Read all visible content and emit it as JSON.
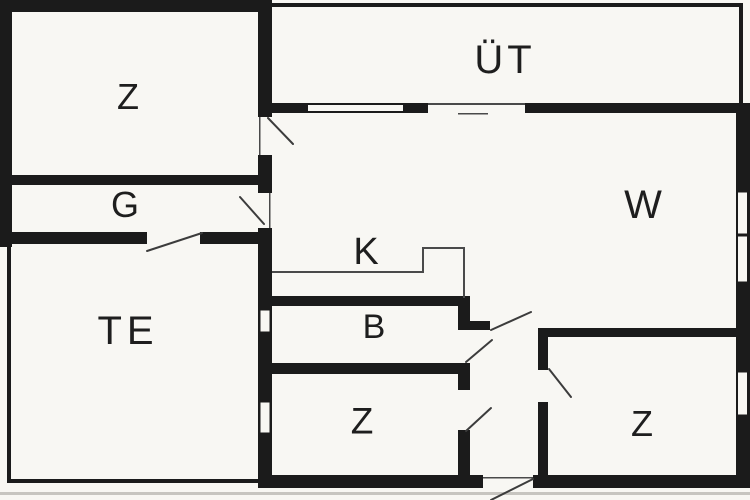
{
  "plan": {
    "title": "floor-plan",
    "rooms": [
      {
        "id": "bedroom-top-left",
        "label": "Z"
      },
      {
        "id": "covered-terrace",
        "label": "ÜT"
      },
      {
        "id": "hall-corridor",
        "label": "G"
      },
      {
        "id": "living-room",
        "label": "W"
      },
      {
        "id": "terrace",
        "label": "TE"
      },
      {
        "id": "kitchen",
        "label": "K"
      },
      {
        "id": "bathroom",
        "label": "B"
      },
      {
        "id": "bedroom-middle",
        "label": "Z"
      },
      {
        "id": "bedroom-right",
        "label": "Z"
      }
    ],
    "colors": {
      "wall": "#1b1b1b",
      "floor": "#f8f7f3",
      "ink": "#1e1e1e",
      "swing": "#3c3c3c",
      "thin_line": "#4a4a4a",
      "scan_shadow": "#c7c5c0"
    }
  }
}
